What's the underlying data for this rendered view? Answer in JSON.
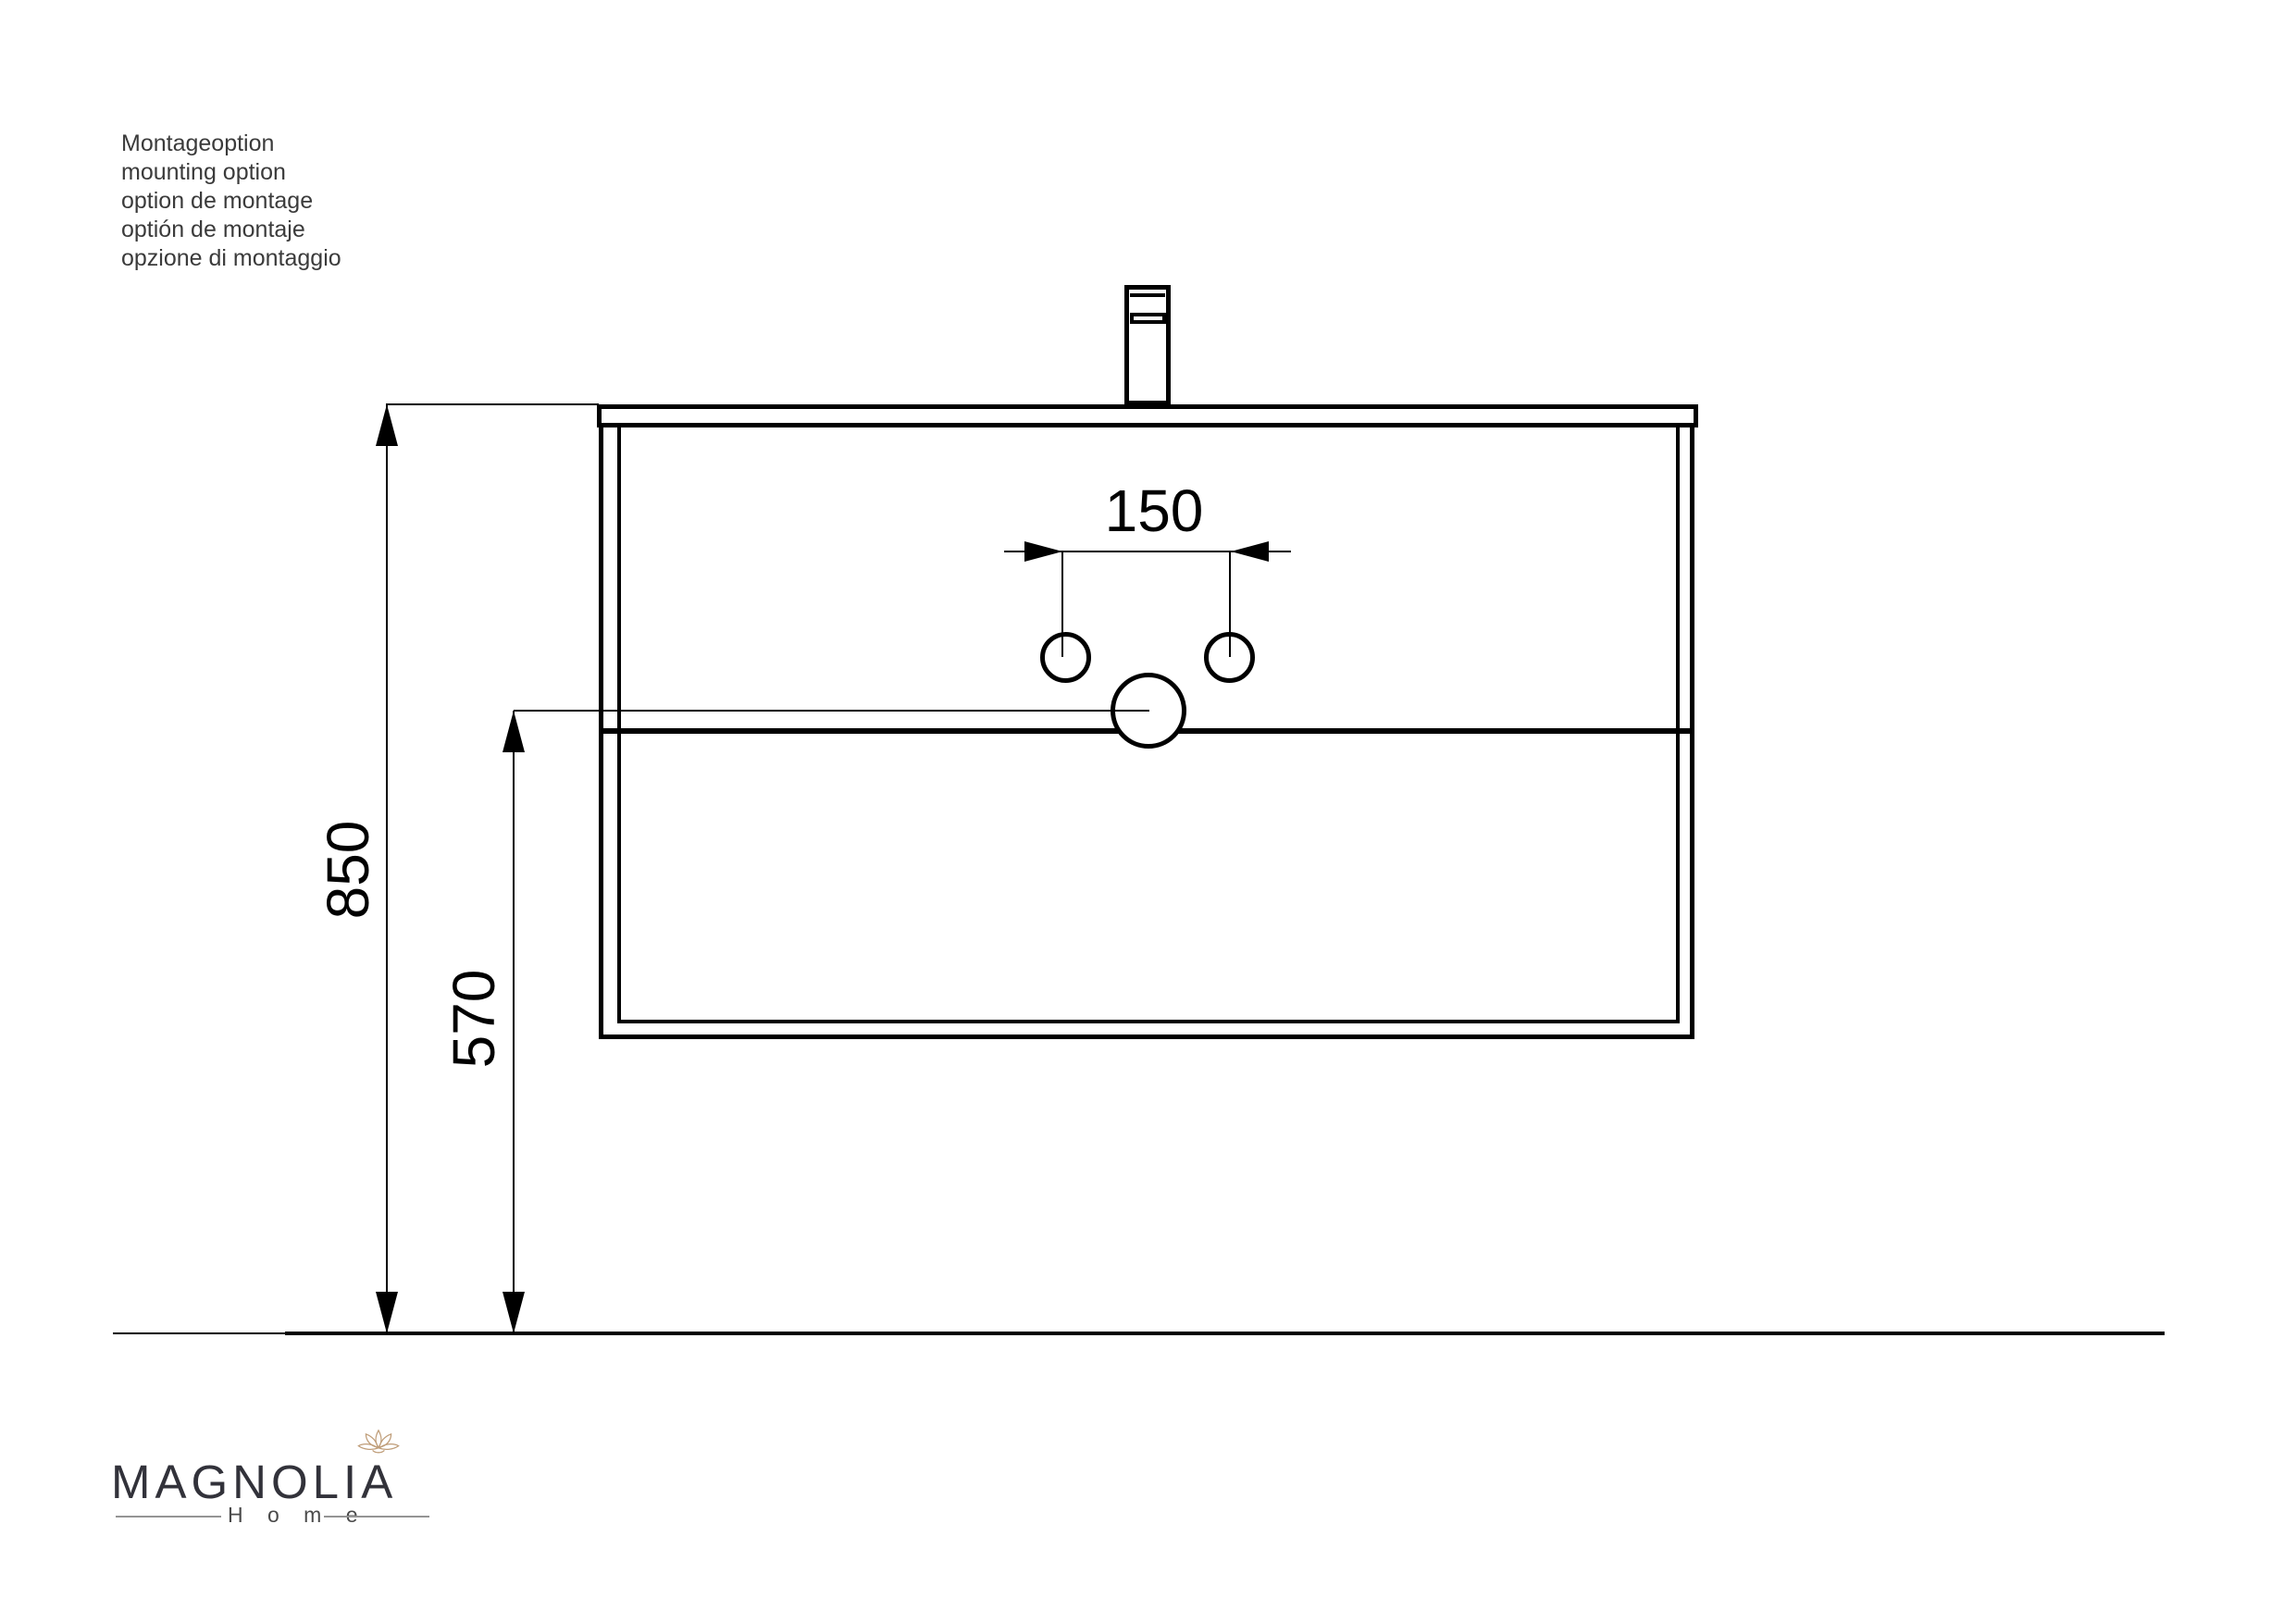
{
  "notes": {
    "lines": [
      "Montageoption",
      "mounting option",
      "option de montage",
      "optión de montaje",
      "opzione di montaggio"
    ]
  },
  "dimensions": {
    "faucet_hole_spacing": "150",
    "mounting_height": "850",
    "drain_height": "570"
  },
  "logo": {
    "brand": "MAGNOLIA",
    "subtitle": "H o m e"
  },
  "colors": {
    "drawing_line": "#000000",
    "brand_text": "#32323a",
    "flower_outline": "#bf9d78",
    "notes_text": "#3b3b3b"
  }
}
